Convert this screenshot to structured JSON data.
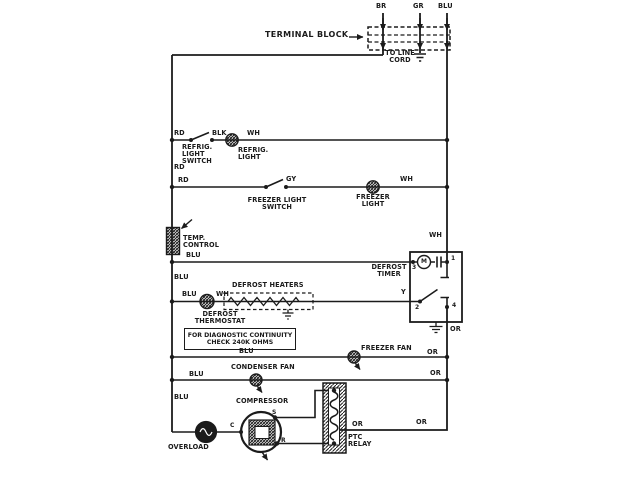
{
  "colors": {
    "ink": "#1b1b1b",
    "bg": "#ffffff"
  },
  "labels": {
    "terminal_block": "TERMINAL BLOCK",
    "wire_br": "BR",
    "wire_gr": "GR",
    "wire_blu_top": "BLU",
    "to_line_cord": "TO LINE\nCORD",
    "rd_row1": "RD",
    "blk_row1": "BLK",
    "wh_row1": "WH",
    "refrig_light_switch": "REFRIG.\nLIGHT\nSWITCH",
    "refrig_light": "REFRIG.\nLIGHT",
    "rd_left": "RD",
    "rd_row2": "RD",
    "gy_row2": "GY",
    "wh_row2": "WH",
    "freezer_light_switch": "FREEZER LIGHT\nSWITCH",
    "freezer_light": "FREEZER\nLIGHT",
    "temp_control": "TEMP.\nCONTROL",
    "blu_row3": "BLU",
    "blu_left": "BLU",
    "wh_right": "WH",
    "defrost_timer": "DEFROST\nTIMER",
    "timer_motor": "M",
    "timer_terminal_1": "1",
    "timer_terminal_2": "2",
    "timer_terminal_3": "3",
    "timer_terminal_4": "4",
    "defrost_heaters": "DEFROST HEATERS",
    "blu_row4": "BLU",
    "wh_row4": "WH",
    "y_row4": "Y",
    "defrost_thermostat": "DEFROST\nTHERMOSTAT",
    "diag_note_line1": "FOR DIAGNOSTIC CONTINUITY",
    "diag_note_line2": "CHECK 240K OHMS",
    "blu_row5": "BLU",
    "freezer_fan": "FREEZER FAN",
    "or_row5": "OR",
    "or_right": "OR",
    "condenser_fan": "CONDENSER FAN",
    "blu_row6": "BLU",
    "or_row6": "OR",
    "blu_bottom": "BLU",
    "compressor": "COMPRESSOR",
    "terminal_c": "C",
    "terminal_s": "S",
    "terminal_r": "R",
    "overload": "OVERLOAD",
    "ptc_relay": "PTC\nRELAY",
    "or_bottom_left": "OR",
    "or_bottom_right": "OR"
  }
}
